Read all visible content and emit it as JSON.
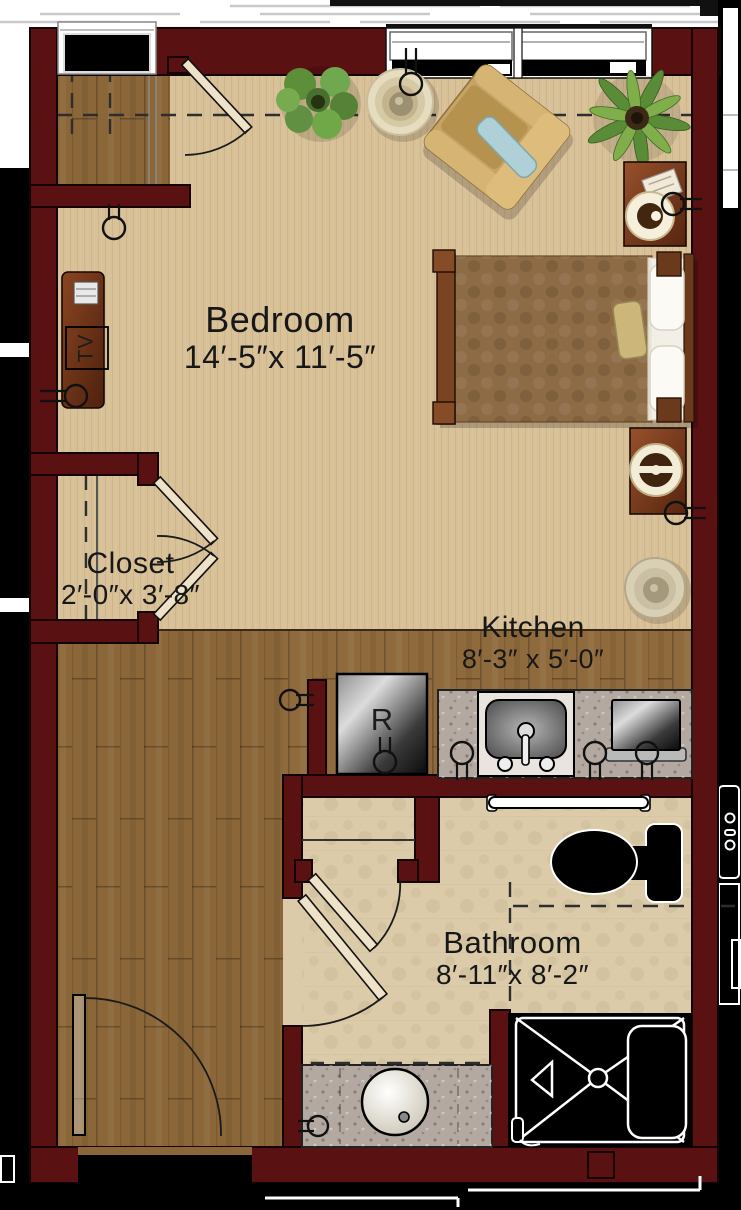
{
  "plan": {
    "title": "Studio apartment floor plan",
    "rooms": {
      "bedroom": {
        "name": "Bedroom",
        "dims": "14′-5″x 11′-5″"
      },
      "closet": {
        "name": "Closet",
        "dims": "2′-0″x 3′-8″"
      },
      "kitchen": {
        "name": "Kitchen",
        "dims": "8′-3″ x 5′-0″"
      },
      "bathroom": {
        "name": "Bathroom",
        "dims": "8′-11″x 8′-2″"
      }
    },
    "appliances": {
      "refrigerator_label": "R",
      "tv_label": "TV"
    },
    "fixtures": [
      "entry-door",
      "entry-closet",
      "closet-double-doors",
      "tv-console",
      "media-player",
      "armchair",
      "accent-pillow",
      "round-side-table",
      "leafy-potted-plant",
      "palm-plant",
      "bed",
      "comforter",
      "pillows",
      "nightstand-with-lamp",
      "nightstand-with-lamp",
      "round-accent-table",
      "refrigerator",
      "kitchen-counter",
      "kitchen-sink",
      "microwave",
      "bathroom-storage-alcove",
      "bathroom-doors",
      "toilet",
      "grab-bar",
      "vanity-counter",
      "round-vanity-sink",
      "walk-in-shower",
      "corner-shelf",
      "shower-bench",
      "electrical-outlets",
      "windows"
    ],
    "colors": {
      "wall": "#5a1111",
      "carpet": "#d8c097",
      "wood": "#8a6638",
      "kitchen_wood": "#8f6a3c",
      "tile": "#dbcba9",
      "counter": "#b3a9a1",
      "comforter": "#8d6b44",
      "pillow_blue": "#aed0d6",
      "furniture_wood": "#7a3b1e",
      "plant": "#6aa04c",
      "text": "#171717"
    }
  }
}
